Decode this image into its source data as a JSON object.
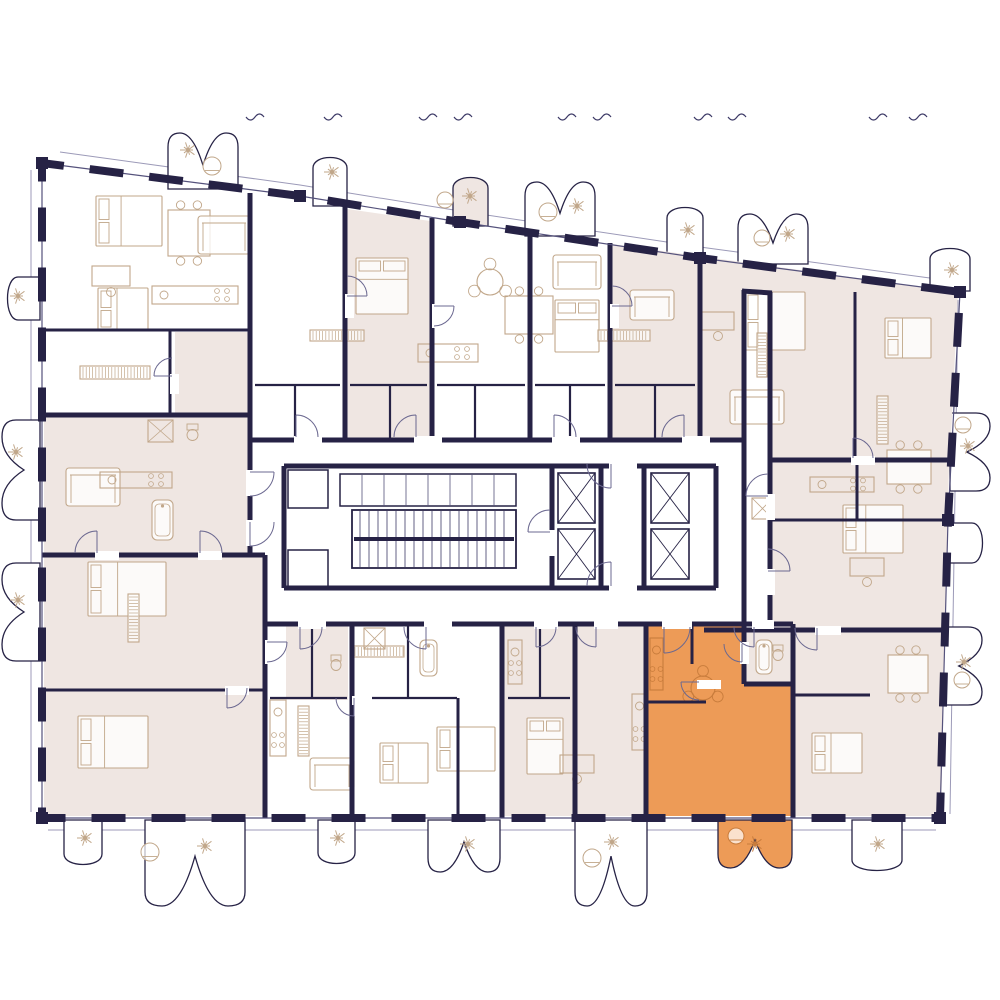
{
  "colors": {
    "wall": "#262245",
    "line": "#55527c",
    "door": "#6b6890",
    "furniture": "#c1a78a",
    "furn_orange": "#c87c3c",
    "beige": "#efe6e2",
    "orange": "#ED9B57",
    "white": "#ffffff",
    "tread": "#3c3966",
    "tick": "#3c3966",
    "facade": "#9c9ab8"
  },
  "canvas": {
    "width": 1000,
    "height": 1000
  },
  "building": {
    "outline": [
      [
        42,
        163
      ],
      [
        300,
        196
      ],
      [
        460,
        222
      ],
      [
        700,
        258
      ],
      [
        960,
        292
      ],
      [
        948,
        520
      ],
      [
        940,
        818
      ],
      [
        42,
        818
      ]
    ],
    "wall_dash": "34 26"
  },
  "facade_lines": [
    [
      [
        60,
        152
      ],
      [
        300,
        185
      ],
      [
        460,
        211
      ],
      [
        700,
        247
      ],
      [
        952,
        281
      ]
    ],
    [
      [
        48,
        830
      ],
      [
        936,
        830
      ]
    ],
    [
      [
        31,
        170
      ],
      [
        31,
        812
      ]
    ],
    [
      [
        958,
        300
      ],
      [
        950,
        814
      ]
    ]
  ],
  "apartment_regions": [
    [
      [
        44,
        417
      ],
      [
        248,
        417
      ],
      [
        248,
        553
      ],
      [
        44,
        553
      ]
    ],
    [
      [
        175,
        332
      ],
      [
        248,
        332
      ],
      [
        248,
        417
      ],
      [
        175,
        417
      ]
    ],
    [
      [
        44,
        557
      ],
      [
        263,
        557
      ],
      [
        263,
        816
      ],
      [
        44,
        816
      ]
    ],
    [
      [
        347,
        209
      ],
      [
        430,
        221
      ],
      [
        430,
        438
      ],
      [
        347,
        438
      ]
    ],
    [
      [
        612,
        244
      ],
      [
        958,
        292
      ],
      [
        950,
        458
      ],
      [
        772,
        458
      ],
      [
        772,
        292
      ],
      [
        744,
        288
      ],
      [
        744,
        438
      ],
      [
        612,
        438
      ]
    ],
    [
      [
        772,
        462
      ],
      [
        949,
        462
      ],
      [
        941,
        816
      ],
      [
        704,
        816
      ],
      [
        704,
        632
      ],
      [
        772,
        632
      ]
    ],
    [
      [
        504,
        626
      ],
      [
        644,
        626
      ],
      [
        644,
        816
      ],
      [
        504,
        816
      ]
    ],
    [
      [
        286,
        626
      ],
      [
        348,
        626
      ],
      [
        348,
        700
      ],
      [
        286,
        700
      ]
    ]
  ],
  "selected_apartment": {
    "fill": "#ED9B57",
    "outline": [
      [
        646,
        626
      ],
      [
        744,
        626
      ],
      [
        744,
        684
      ],
      [
        793,
        684
      ],
      [
        793,
        816
      ],
      [
        646,
        816
      ]
    ],
    "balcony": {
      "s": "b",
      "x": 718,
      "y": 820,
      "w": 74,
      "d": 48,
      "l": 2
    }
  },
  "balconies": [
    {
      "s": "t",
      "x": 168,
      "y": 189,
      "w": 70,
      "d": 56,
      "l": 2
    },
    {
      "s": "t",
      "x": 313,
      "y": 206,
      "w": 34,
      "d": 52,
      "l": 1
    },
    {
      "s": "t",
      "x": 453,
      "y": 226,
      "w": 35,
      "d": 52,
      "l": 1,
      "f": "beige"
    },
    {
      "s": "t",
      "x": 525,
      "y": 236,
      "w": 70,
      "d": 54,
      "l": 2
    },
    {
      "s": "t",
      "x": 667,
      "y": 256,
      "w": 36,
      "d": 52,
      "l": 1
    },
    {
      "s": "t",
      "x": 738,
      "y": 264,
      "w": 70,
      "d": 50,
      "l": 2
    },
    {
      "s": "t",
      "x": 930,
      "y": 291,
      "w": 40,
      "d": 46,
      "l": 1
    },
    {
      "s": "b",
      "x": 64,
      "y": 820,
      "w": 38,
      "d": 48,
      "l": 1
    },
    {
      "s": "b",
      "x": 145,
      "y": 820,
      "w": 100,
      "d": 86,
      "l": 2
    },
    {
      "s": "b",
      "x": 318,
      "y": 820,
      "w": 37,
      "d": 47,
      "l": 1
    },
    {
      "s": "b",
      "x": 428,
      "y": 820,
      "w": 72,
      "d": 52,
      "l": 2
    },
    {
      "s": "b",
      "x": 575,
      "y": 820,
      "w": 72,
      "d": 86,
      "l": 2
    },
    {
      "s": "b",
      "x": 852,
      "y": 820,
      "w": 50,
      "d": 54,
      "l": 1
    },
    {
      "s": "l",
      "x": 40,
      "y": 277,
      "w": 43,
      "d": 36,
      "l": 1
    },
    {
      "s": "l",
      "x": 40,
      "y": 420,
      "w": 100,
      "d": 38,
      "l": 2
    },
    {
      "s": "l",
      "x": 40,
      "y": 563,
      "w": 98,
      "d": 38,
      "l": 2
    },
    {
      "s": "r",
      "x": 950,
      "y": 413,
      "w": 78,
      "d": 40,
      "l": 2
    },
    {
      "s": "r",
      "x": 946,
      "y": 523,
      "w": 40,
      "d": 40,
      "l": 1
    },
    {
      "s": "r",
      "x": 942,
      "y": 627,
      "w": 78,
      "d": 40,
      "l": 2
    }
  ],
  "walls_thick": [
    [
      250,
      193,
      250,
      440
    ],
    [
      345,
      206,
      345,
      440
    ],
    [
      432,
      218,
      432,
      440
    ],
    [
      530,
      231,
      530,
      440
    ],
    [
      610,
      243,
      610,
      440
    ],
    [
      700,
      255,
      700,
      440
    ],
    [
      744,
      290,
      744,
      624
    ],
    [
      770,
      292,
      770,
      624
    ],
    [
      742,
      291,
      772,
      293
    ],
    [
      770,
      460,
      952,
      460
    ],
    [
      704,
      630,
      943,
      630
    ],
    [
      42,
      415,
      250,
      415
    ],
    [
      42,
      555,
      265,
      555
    ],
    [
      265,
      555,
      265,
      818
    ],
    [
      250,
      415,
      250,
      555
    ],
    [
      250,
      440,
      744,
      440
    ],
    [
      265,
      624,
      793,
      624
    ],
    [
      352,
      624,
      352,
      818
    ],
    [
      502,
      624,
      502,
      818
    ],
    [
      575,
      624,
      575,
      818
    ],
    [
      646,
      624,
      646,
      818
    ],
    [
      793,
      624,
      793,
      818
    ],
    [
      744,
      624,
      744,
      684
    ],
    [
      744,
      684,
      793,
      684
    ]
  ],
  "walls_med": [
    [
      42,
      330,
      250,
      330
    ],
    [
      170,
      330,
      170,
      415
    ],
    [
      42,
      690,
      265,
      690
    ],
    [
      770,
      520,
      949,
      520
    ],
    [
      857,
      460,
      857,
      520
    ],
    [
      855,
      292,
      855,
      458
    ],
    [
      795,
      695,
      870,
      695
    ],
    [
      458,
      698,
      458,
      818
    ],
    [
      692,
      626,
      692,
      664
    ],
    [
      646,
      702,
      706,
      702
    ]
  ],
  "walls_thin": [
    [
      255,
      385,
      340,
      385
    ],
    [
      350,
      385,
      427,
      385
    ],
    [
      437,
      385,
      525,
      385
    ],
    [
      535,
      385,
      605,
      385
    ],
    [
      615,
      385,
      695,
      385
    ],
    [
      295,
      385,
      295,
      440
    ],
    [
      390,
      385,
      390,
      440
    ],
    [
      475,
      385,
      475,
      440
    ],
    [
      570,
      385,
      570,
      440
    ],
    [
      655,
      385,
      655,
      440
    ],
    [
      270,
      698,
      347,
      698
    ],
    [
      357,
      698,
      457,
      698
    ],
    [
      508,
      698,
      570,
      698
    ],
    [
      312,
      624,
      312,
      698
    ],
    [
      408,
      624,
      408,
      698
    ],
    [
      540,
      624,
      540,
      698
    ]
  ],
  "core": {
    "interior": [
      286,
      468,
      428,
      118
    ],
    "walls": [
      [
        284,
        466,
        716,
        466
      ],
      [
        284,
        588,
        716,
        588
      ],
      [
        284,
        466,
        284,
        588
      ],
      [
        716,
        466,
        716,
        588
      ],
      [
        552,
        466,
        552,
        588
      ],
      [
        601,
        466,
        601,
        588
      ],
      [
        644,
        466,
        644,
        588
      ]
    ],
    "stairs": {
      "rect": [
        352,
        510,
        164,
        58
      ],
      "step": 9
    },
    "lockers": {
      "rect": [
        340,
        474,
        176,
        32
      ],
      "step": 22
    },
    "rooms": [
      [
        288,
        470,
        40,
        38
      ],
      [
        288,
        550,
        40,
        38
      ]
    ],
    "elevators": [
      [
        558,
        473,
        37,
        50
      ],
      [
        558,
        529,
        37,
        50
      ],
      [
        651,
        473,
        38,
        50
      ],
      [
        651,
        529,
        38,
        50
      ]
    ]
  },
  "wall_gaps": [
    [
      294,
      436,
      28,
      9
    ],
    [
      414,
      436,
      28,
      9
    ],
    [
      552,
      436,
      28,
      9
    ],
    [
      682,
      436,
      28,
      9
    ],
    [
      298,
      620,
      28,
      9
    ],
    [
      424,
      620,
      28,
      9
    ],
    [
      534,
      620,
      24,
      9
    ],
    [
      594,
      620,
      24,
      9
    ],
    [
      662,
      620,
      30,
      9
    ],
    [
      752,
      620,
      22,
      9
    ],
    [
      246,
      470,
      9,
      26
    ],
    [
      246,
      520,
      9,
      26
    ],
    [
      766,
      494,
      9,
      26
    ],
    [
      766,
      569,
      9,
      26
    ],
    [
      609,
      462,
      28,
      9
    ],
    [
      609,
      584,
      28,
      9
    ],
    [
      548,
      530,
      9,
      26
    ],
    [
      740,
      642,
      9,
      22
    ],
    [
      697,
      680,
      24,
      9
    ],
    [
      815,
      626,
      26,
      9
    ],
    [
      851,
      456,
      24,
      9
    ],
    [
      345,
      294,
      9,
      24
    ],
    [
      432,
      304,
      9,
      24
    ],
    [
      610,
      304,
      9,
      24
    ],
    [
      265,
      640,
      9,
      24
    ],
    [
      198,
      551,
      24,
      9
    ],
    [
      225,
      686,
      24,
      9
    ],
    [
      95,
      551,
      24,
      9
    ],
    [
      170,
      374,
      9,
      20
    ],
    [
      352,
      696,
      20,
      9
    ]
  ],
  "doors": [
    [
      296,
      437,
      22,
      270,
      0
    ],
    [
      416,
      437,
      22,
      270,
      1
    ],
    [
      554,
      437,
      22,
      270,
      0
    ],
    [
      684,
      437,
      22,
      270,
      1
    ],
    [
      300,
      627,
      22,
      90,
      1
    ],
    [
      426,
      627,
      22,
      90,
      0
    ],
    [
      536,
      627,
      20,
      90,
      1
    ],
    [
      596,
      627,
      20,
      90,
      0
    ],
    [
      664,
      627,
      26,
      90,
      1
    ],
    [
      754,
      627,
      20,
      90,
      0
    ],
    [
      250,
      472,
      24,
      0,
      0
    ],
    [
      250,
      522,
      24,
      90,
      1
    ],
    [
      768,
      496,
      22,
      180,
      0
    ],
    [
      768,
      571,
      22,
      0,
      1
    ],
    [
      611,
      464,
      24,
      90,
      0
    ],
    [
      611,
      586,
      24,
      270,
      1
    ],
    [
      550,
      532,
      22,
      180,
      0
    ],
    [
      742,
      644,
      18,
      90,
      0
    ],
    [
      699,
      682,
      18,
      180,
      1
    ],
    [
      817,
      628,
      22,
      90,
      0
    ],
    [
      853,
      458,
      20,
      270,
      0
    ],
    [
      347,
      296,
      20,
      0,
      1
    ],
    [
      434,
      306,
      20,
      0,
      0
    ],
    [
      612,
      306,
      20,
      0,
      1
    ],
    [
      267,
      642,
      20,
      0,
      0
    ],
    [
      200,
      553,
      22,
      270,
      0
    ],
    [
      227,
      688,
      20,
      90,
      1
    ],
    [
      97,
      553,
      22,
      270,
      1
    ],
    [
      172,
      376,
      18,
      180,
      0
    ],
    [
      354,
      698,
      18,
      90,
      0
    ]
  ],
  "furniture": [
    [
      "bed",
      96,
      196,
      66,
      50
    ],
    [
      "bed",
      98,
      288,
      50,
      42
    ],
    [
      "bed",
      356,
      258,
      52,
      56
    ],
    [
      "bed",
      88,
      562,
      78,
      54
    ],
    [
      "bed",
      78,
      716,
      70,
      52
    ],
    [
      "bed",
      745,
      292,
      60,
      58
    ],
    [
      "bed",
      885,
      318,
      46,
      40
    ],
    [
      "bed",
      843,
      505,
      60,
      48
    ],
    [
      "bed",
      437,
      727,
      58,
      44
    ],
    [
      "bed",
      527,
      718,
      36,
      56
    ],
    [
      "bed",
      812,
      733,
      50,
      40
    ],
    [
      "bed",
      380,
      743,
      48,
      40
    ],
    [
      "bed",
      555,
      300,
      44,
      52
    ],
    [
      "tbl",
      168,
      210,
      42,
      46
    ],
    [
      "tbl",
      505,
      296,
      48,
      38
    ],
    [
      "tbl",
      887,
      450,
      44,
      34
    ],
    [
      "tbl",
      888,
      655,
      40,
      38
    ],
    [
      "rnd",
      490,
      282,
      13
    ],
    [
      "rnd",
      703,
      688,
      12,
      "o"
    ],
    [
      "sof",
      198,
      216,
      52,
      38
    ],
    [
      "sof",
      66,
      468,
      54,
      38
    ],
    [
      "sof",
      553,
      255,
      48,
      34
    ],
    [
      "sof",
      730,
      390,
      54,
      34
    ],
    [
      "sof",
      310,
      758,
      44,
      32
    ],
    [
      "sof",
      630,
      290,
      44,
      30
    ],
    [
      "kit",
      152,
      286,
      86,
      18
    ],
    [
      "kit",
      418,
      344,
      60,
      18
    ],
    [
      "kit",
      100,
      472,
      72,
      16
    ],
    [
      "kit",
      632,
      694,
      15,
      56
    ],
    [
      "kit",
      810,
      477,
      64,
      15
    ],
    [
      "kit",
      270,
      700,
      16,
      56
    ],
    [
      "kit",
      650,
      638,
      13,
      52,
      "o"
    ],
    [
      "kit",
      508,
      640,
      14,
      44
    ],
    [
      "wrd",
      80,
      366,
      70,
      13
    ],
    [
      "wrd",
      310,
      330,
      54,
      11
    ],
    [
      "wrd",
      598,
      330,
      52,
      11
    ],
    [
      "wrd",
      352,
      646,
      52,
      11
    ],
    [
      "wrd",
      877,
      396,
      11,
      48
    ],
    [
      "wrd",
      298,
      706,
      11,
      50
    ],
    [
      "wrd",
      757,
      333,
      10,
      44
    ],
    [
      "wrd",
      128,
      594,
      11,
      48
    ],
    [
      "bath",
      152,
      500,
      21,
      40
    ],
    [
      "bath",
      420,
      640,
      17,
      36
    ],
    [
      "bath",
      756,
      640,
      16,
      34
    ],
    [
      "shw",
      148,
      420,
      25,
      22
    ],
    [
      "shw",
      364,
      628,
      21,
      21
    ],
    [
      "shw",
      752,
      498,
      21,
      21
    ],
    [
      "wc",
      186,
      424,
      13,
      16
    ],
    [
      "wc",
      330,
      655,
      12,
      15
    ],
    [
      "wc",
      772,
      645,
      12,
      15
    ],
    [
      "dsk",
      92,
      266,
      38,
      20
    ],
    [
      "dsk",
      560,
      755,
      34,
      18
    ],
    [
      "dsk",
      850,
      558,
      34,
      18
    ],
    [
      "dsk",
      702,
      312,
      32,
      18
    ],
    [
      "pl",
      188,
      150
    ],
    [
      "pl",
      332,
      172
    ],
    [
      "pl",
      470,
      196
    ],
    [
      "pl",
      577,
      206
    ],
    [
      "pl",
      688,
      230
    ],
    [
      "pl",
      788,
      234
    ],
    [
      "pl",
      18,
      296
    ],
    [
      "pl",
      16,
      452
    ],
    [
      "pl",
      18,
      600
    ],
    [
      "pl",
      85,
      838
    ],
    [
      "pl",
      205,
      846
    ],
    [
      "pl",
      338,
      838
    ],
    [
      "pl",
      468,
      844
    ],
    [
      "pl",
      612,
      842
    ],
    [
      "pl",
      755,
      844,
      "o"
    ],
    [
      "pl",
      878,
      844
    ],
    [
      "pl",
      968,
      446
    ],
    [
      "pl",
      964,
      662
    ],
    [
      "pl",
      952,
      270
    ],
    [
      "arm",
      212,
      166,
      9
    ],
    [
      "arm",
      548,
      212,
      9
    ],
    [
      "arm",
      762,
      238,
      8
    ],
    [
      "arm",
      150,
      852,
      9
    ],
    [
      "arm",
      592,
      858,
      9
    ],
    [
      "arm",
      736,
      836,
      8,
      "o"
    ],
    [
      "arm",
      962,
      680,
      8
    ],
    [
      "arm",
      963,
      425,
      8
    ],
    [
      "arm",
      445,
      200,
      8
    ]
  ],
  "ticks": {
    "y": 117,
    "x": [
      255,
      333,
      428,
      463,
      567,
      602,
      703,
      737,
      878,
      918
    ]
  }
}
